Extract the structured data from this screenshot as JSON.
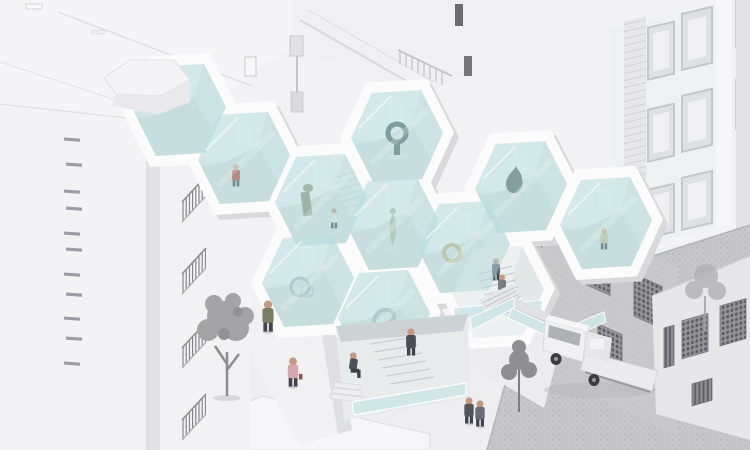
{
  "scene": {
    "title": "Honeycomb gallery pavilion between city buildings",
    "type": "axonometric architectural rendering",
    "style": "monochrome white and gray massing model with pale blue glass and color-accented figures"
  },
  "palette": {
    "background": "#f2f2f4",
    "plaza": "#eeeef0",
    "road": "#c7c7c9",
    "road_speckle": "#aeaeb1",
    "glass_overlay": "rgba(175,216,216,0.5)",
    "glass_solid": "#cfe7e7",
    "frame_white": "#fbfbfc",
    "frame_shadow": "#d9d9dd",
    "interior_floor": "#dce5e5",
    "alley_wall": "#c8c8cb",
    "grille_dark": "#5d5d62",
    "building_white": "#f3f3f5",
    "facade_right": "#eef0f1",
    "tree_gray": "#a4a4a7",
    "tree_dark": "#8f8f93",
    "truck_body": "#eeeeef",
    "accent_red": "#bf3a31",
    "accent_blue": "#7fa3b5",
    "accent_yellow": "#cfc096",
    "accent_pink": "#d6a7ae",
    "accent_olive": "#7b7f63"
  },
  "gallery": {
    "cells": [
      {
        "id": "corner-cell",
        "content": "corner glass cell tucked behind chamfered rooftop"
      },
      {
        "id": "red-shirt-cell",
        "content": "visitor in red shirt viewing empty gallery cell"
      },
      {
        "id": "green-sculpture-cell",
        "content": "bronze abstract sculpture with young visitor and internal stair"
      },
      {
        "id": "dark-ring-cell",
        "content": "dark looped bronze sculpture on plinth"
      },
      {
        "id": "classical-statue-cell",
        "content": "classical stone statue on plinth"
      },
      {
        "id": "steel-rings-cell",
        "content": "polished steel ring sculpture"
      },
      {
        "id": "swan-curve-cell",
        "content": "curved steel sculpture"
      },
      {
        "id": "thinker-cell",
        "content": "seated thinker bronze sculpture"
      },
      {
        "id": "gold-loop-cell",
        "content": "gold loop sculpture with visitor in blue"
      },
      {
        "id": "shopper-cell",
        "content": "visitor in tan cardigan with tote bag"
      },
      {
        "id": "stair-cell",
        "content": "open stair cell with two visitors descending"
      },
      {
        "id": "entry-cell",
        "content": "ground-level entry hexagon with stair, seated visitor and climbing visitor"
      }
    ]
  },
  "people": {
    "outdoor": [
      "man in olive jacket crossing plaza",
      "woman in pink walking past large tree",
      "visitor seated on entry steps",
      "visitor climbing the entry stair",
      "two visitors on the upper outdoor stair",
      "couple strolling near the road"
    ]
  },
  "vehicles": [
    {
      "type": "flatbed-truck",
      "location": "parked on the road beside the right building"
    }
  ],
  "trees": [
    {
      "size": "large",
      "location": "plaza, left of pavilion"
    },
    {
      "size": "small",
      "location": "road edge, lower right"
    },
    {
      "size": "small-faint",
      "location": "far right beside truck"
    }
  ],
  "buildings": {
    "left": "tall white slab with slit windows",
    "left_inner": "white block with triangular balcony railings",
    "top": "rooftop cornice block with railing and hanging sign",
    "right": "classical white facade with framed windows and rusticated strip",
    "alley": "gray textured wall with grated windows",
    "corner": "gray corner block with grated windows"
  }
}
